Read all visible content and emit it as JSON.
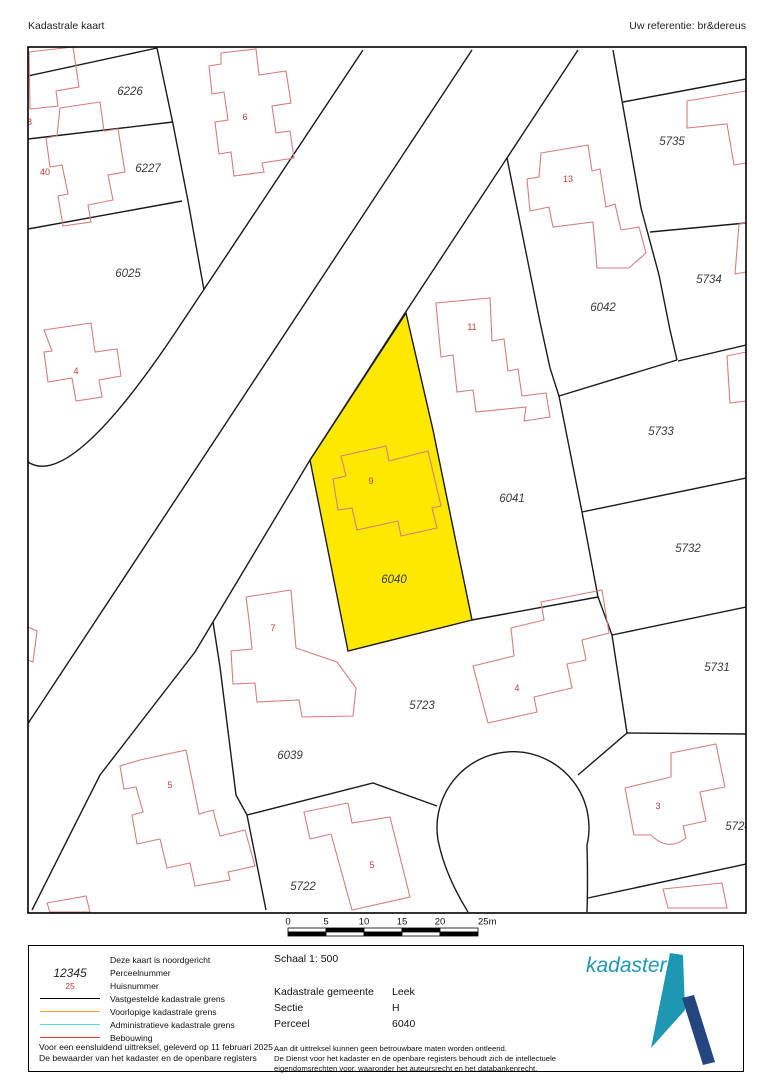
{
  "header": {
    "title": "Kadastrale kaart",
    "reference": "Uw referentie: br&dereus"
  },
  "map": {
    "line_color": "#1a1a1a",
    "building_color": "#d67e7e",
    "number_color": "#c23b3b",
    "label_color": "#3b3b3b",
    "highlight_fill": "#ffe800",
    "border": {
      "x": 28,
      "y": 47,
      "w": 718,
      "h": 866
    },
    "highlight_parcel": {
      "number": "6040",
      "path": "M406,313 L433,430 L458,552 L472,620 L348,651 L310,460 Z"
    },
    "boundaries": [
      "M363,50 L175,333 Q70,490 28,462",
      "M472,50 L27,725",
      "M578,50 L405,313 L310,460 L195,652 L100,775 L32,910",
      "M28,76 L157,48",
      "M28,139 L173,122",
      "M28,229 L182,201",
      "M157,48 L173,124 L188,201 L204,290",
      "M613,50 L641,208 L659,275 L670,330",
      "M507,158 L540,322 L550,368 L559,396",
      "M559,396 L677,360",
      "M670,330 L677,360",
      "M623,102 L746,79",
      "M650,232 L746,223",
      "M678,361 L746,345",
      "M559,396 L582,512 L598,597 L612,635",
      "M582,512 L746,478",
      "M612,635 L746,607",
      "M612,635 L627,733",
      "M627,733 L746,734",
      "M627,733 L578,775",
      "M588,898 L746,864",
      "M472,620 L598,597",
      "M468,912 Q445,875 438,840 A76,76 0 1 1 587,845 Q588,880 587,912",
      "M213,622 L220,667 L236,795 L247,815 L266,910",
      "M247,815 L373,783 L437,806"
    ],
    "buildings": [
      {
        "name": "building-38",
        "d": "M29,52 L73,47 L79,87 L56,91 L58,106 L30,109 Z"
      },
      {
        "name": "building-40",
        "d": "M60,108 L100,102 L104,131 L118,129 L125,172 L108,175 L113,200 L88,205 L91,222 L63,226 L58,196 L68,194 L62,165 L50,167 L46,138 L57,136 Z"
      },
      {
        "name": "building-6",
        "d": "M221,53 L256,49 L259,75 L286,71 L291,103 L272,106 L276,133 L290,131 L294,158 L262,163 L264,172 L234,176 L231,152 L219,154 L215,122 L228,120 L224,92 L212,94 L209,66 L221,64 Z"
      },
      {
        "name": "building-4-left",
        "d": "M44,330 L91,323 L95,352 L117,349 L121,376 L99,380 L102,397 L76,401 L72,378 L48,382 L44,352 L52,351 Z"
      },
      {
        "name": "building-13",
        "d": "M541,153 L588,145 L592,171 L600,169 L606,207 L615,204 L621,230 L639,227 L646,253 L629,268 L597,268 L593,222 L553,227 L549,207 L530,211 L527,179 L539,177 Z"
      },
      {
        "name": "building-11",
        "d": "M438,326 L436,303 L490,298 L492,341 L504,339 L508,371 L518,369 L522,396 L546,393 L550,417 L524,421 L526,407 L476,412 L473,390 L457,392 L453,355 L441,357 Z"
      },
      {
        "name": "building-9",
        "d": "M341,456 L386,446 L389,461 L428,451 L441,506 L432,508 L437,528 L401,536 L398,521 L357,530 L352,508 L338,510 L333,479 L346,476 Z"
      },
      {
        "name": "building-7",
        "d": "M246,597 L291,590 L296,648 L337,662 L356,688 L353,716 L302,717 L299,700 L257,702 L255,683 L233,684 L231,651 L252,649 L249,620 Z"
      },
      {
        "name": "building-5-left",
        "d": "M140,760 L186,750 L199,814 L213,810 L220,836 L245,830 L255,866 L228,872 L230,880 L195,886 L190,863 L167,868 L160,839 L137,844 L132,815 L143,812 L136,787 L124,789 L120,766 Z"
      },
      {
        "name": "building-5-bottom",
        "d": "M304,812 L348,803 L352,823 L390,817 L410,897 L352,910 L331,834 L310,839 Z"
      },
      {
        "name": "building-4-mid",
        "d": "M473,666 L514,656 L511,628 L544,620 L541,602 L602,590 L609,633 L582,640 L586,660 L567,664 L572,688 L534,697 L537,712 L488,723 Z"
      },
      {
        "name": "building-3",
        "d": "M671,753 L716,744 L725,787 L700,792 L706,821 L683,826 L686,838 Q668,852 651,835 L634,835 L625,788 L671,777 Z"
      },
      {
        "name": "building-partial-5735",
        "d": "M687,101 L746,91 L746,163 L734,165 L727,124 L687,128 Z"
      },
      {
        "name": "building-partial-5734",
        "d": "M739,224 L746,223 L746,272 L735,274 Z"
      },
      {
        "name": "building-partial-5732",
        "d": "M727,356 L746,352 L746,401 L730,403 Z"
      },
      {
        "name": "building-partial-bottom-right",
        "d": "M663,889 L722,883 L727,908 L668,908 Z"
      },
      {
        "name": "building-partial-bottom-left",
        "d": "M47,903 L86,896 L90,912 L50,912 Z"
      },
      {
        "name": "building-partial-left-edge",
        "d": "M28,627 L37,631 L33,662 L28,660 Z"
      }
    ],
    "parcel_labels": [
      {
        "text": "6226",
        "x": 130,
        "y": 95
      },
      {
        "text": "6227",
        "x": 148,
        "y": 172
      },
      {
        "text": "6025",
        "x": 128,
        "y": 277
      },
      {
        "text": "6042",
        "x": 603,
        "y": 311
      },
      {
        "text": "5735",
        "x": 672,
        "y": 145
      },
      {
        "text": "5734",
        "x": 709,
        "y": 283
      },
      {
        "text": "5733",
        "x": 661,
        "y": 435
      },
      {
        "text": "5732",
        "x": 688,
        "y": 552
      },
      {
        "text": "5731",
        "x": 717,
        "y": 671
      },
      {
        "text": "5724",
        "x": 738,
        "y": 830
      },
      {
        "text": "6041",
        "x": 512,
        "y": 502
      },
      {
        "text": "6040",
        "x": 394,
        "y": 583
      },
      {
        "text": "5723",
        "x": 422,
        "y": 709
      },
      {
        "text": "6039",
        "x": 290,
        "y": 759
      },
      {
        "text": "5722",
        "x": 303,
        "y": 890
      }
    ],
    "house_numbers": [
      {
        "text": "38",
        "x": 27,
        "y": 125
      },
      {
        "text": "40",
        "x": 45,
        "y": 175
      },
      {
        "text": "6",
        "x": 245,
        "y": 120
      },
      {
        "text": "13",
        "x": 568,
        "y": 182
      },
      {
        "text": "11",
        "x": 472,
        "y": 330
      },
      {
        "text": "9",
        "x": 371,
        "y": 484
      },
      {
        "text": "4",
        "x": 76,
        "y": 374
      },
      {
        "text": "7",
        "x": 273,
        "y": 631
      },
      {
        "text": "5",
        "x": 170,
        "y": 788
      },
      {
        "text": "4",
        "x": 517,
        "y": 691
      },
      {
        "text": "5",
        "x": 372,
        "y": 868
      },
      {
        "text": "3",
        "x": 658,
        "y": 809
      }
    ],
    "scale_bar": {
      "x": 288,
      "y": 928,
      "segment_px": 38,
      "rows": 2,
      "row_h": 4,
      "labels": [
        "0",
        "5",
        "10",
        "15",
        "20",
        "25m"
      ]
    }
  },
  "legend": {
    "rows": [
      {
        "sample": "none",
        "sample_text": "",
        "color": "",
        "label": "Deze kaart is noordgericht"
      },
      {
        "sample": "text-parcel",
        "sample_text": "12345",
        "color": "",
        "label": "Perceelnummer"
      },
      {
        "sample": "text-house",
        "sample_text": "25",
        "color": "",
        "label": "Huisnummer"
      },
      {
        "sample": "line",
        "sample_text": "",
        "color": "#000000",
        "label": "Vastgestelde kadastrale grens"
      },
      {
        "sample": "line",
        "sample_text": "",
        "color": "#efa51e",
        "label": "Voorlopige kadastrale grens"
      },
      {
        "sample": "line",
        "sample_text": "",
        "color": "#4fe3d4",
        "label": "Administratieve kadastrale grens"
      },
      {
        "sample": "line",
        "sample_text": "",
        "color": "#e23b3b",
        "label": "Bebouwing"
      }
    ],
    "footer_lines": [
      "Voor een eensluidend uittreksel, geleverd op 11 februari 2025",
      "De bewaarder van het kadaster en de openbare registers"
    ]
  },
  "details": {
    "schaal": "Schaal 1: 500",
    "rows": [
      {
        "label": "Kadastrale gemeente",
        "value": "Leek"
      },
      {
        "label": "Sectie",
        "value": "H"
      },
      {
        "label": "Perceel",
        "value": "6040"
      }
    ],
    "disclaimer": [
      "Aan dit uittreksel kunnen geen betrouwbare maten worden ontleend.",
      "De Dienst voor het kadaster en de openbare registers behoudt zich de intellectuele",
      "eigendomsrechten voor, waaronder het auteursrecht en het databankenrecht."
    ]
  },
  "logo": {
    "text": "kadaster",
    "teal": "#1e97b2",
    "navy": "#24457f"
  }
}
